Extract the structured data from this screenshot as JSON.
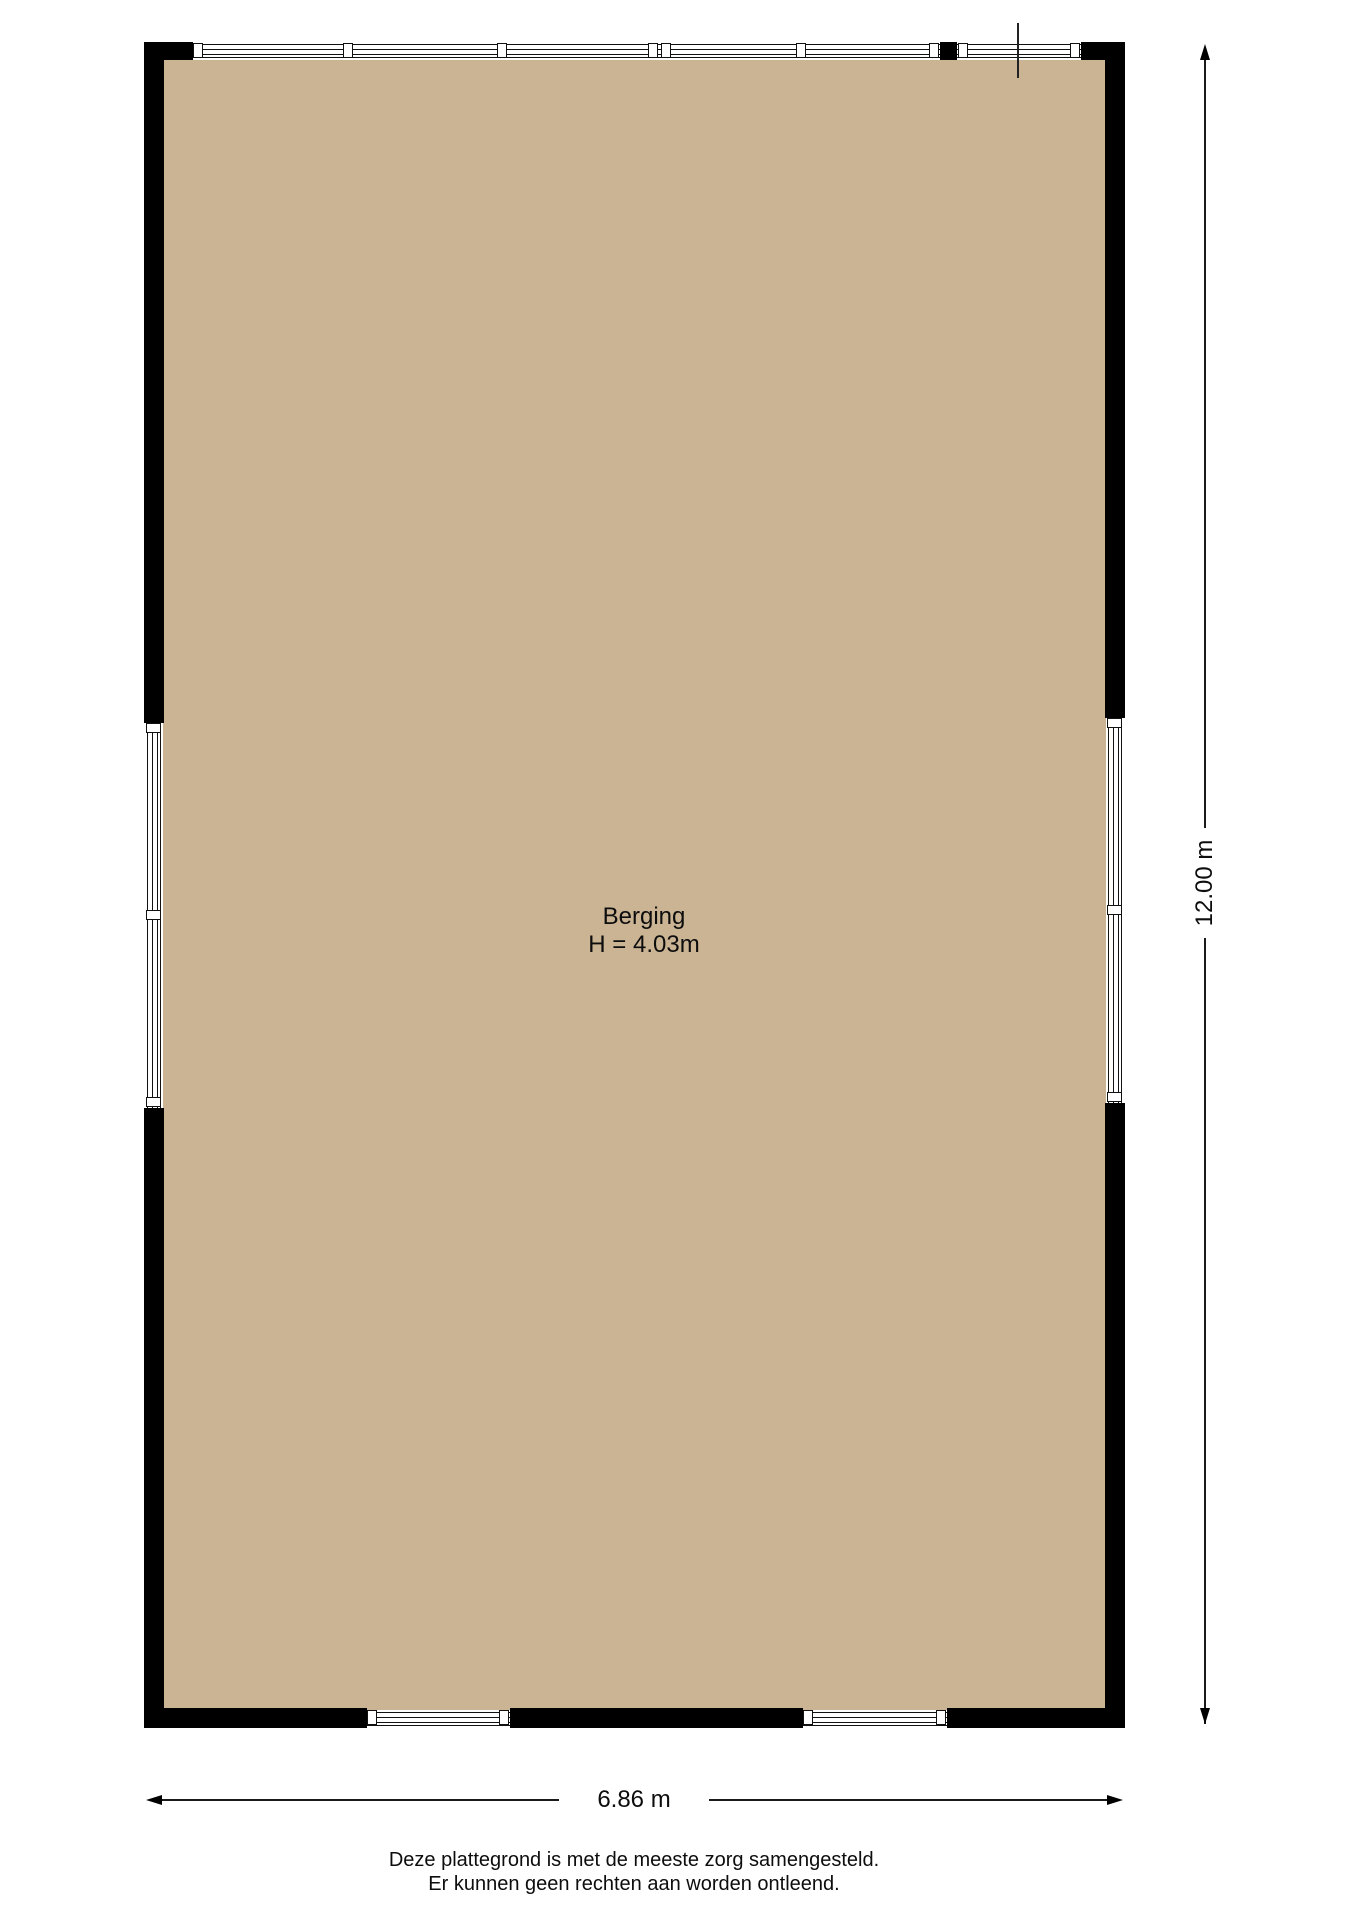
{
  "plan": {
    "type": "floor-plan",
    "room": {
      "name": "Berging",
      "ceiling_height": "H = 4.03m"
    }
  },
  "dimensions": {
    "vertical": "12.00 m",
    "horizontal": "6.86 m"
  },
  "disclaimer": {
    "line1": "Deze plattegrond is met de meeste zorg samengesteld.",
    "line2": "Er kunnen geen rechten aan worden ontleend."
  },
  "colors": {
    "floor": "#CBB493",
    "wall": "#000000",
    "line": "#111111",
    "background": "#FFFFFF"
  }
}
